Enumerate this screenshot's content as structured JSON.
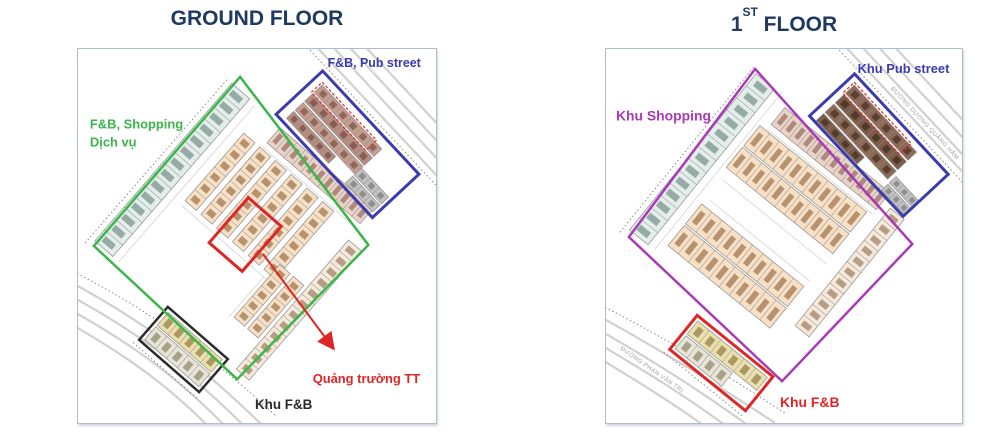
{
  "header": {
    "ground_title": "GROUND FLOOR",
    "first_title_num": "1",
    "first_title_sup": "ST",
    "first_title_rest": " FLOOR",
    "title_color": "#1e3a62"
  },
  "panels": {
    "ground": {
      "zones": {
        "shopping": {
          "label_line1": "F&B, Shopping",
          "label_line2": "Dịch vụ",
          "color": "#3cb54a"
        },
        "pub": {
          "label": "F&B, Pub street",
          "color": "#3b3bae"
        },
        "fnb": {
          "label": "Khu F&B",
          "color": "#2b2b2b"
        },
        "square": {
          "label": "Quảng trường TT",
          "color": "#e02525"
        }
      }
    },
    "first": {
      "zones": {
        "shopping": {
          "label": "Khu Shopping",
          "color": "#a83ab8"
        },
        "pub": {
          "label": "Khu Pub street",
          "color": "#3b3bae"
        },
        "fnb": {
          "label": "Khu F&B",
          "color": "#e02525"
        }
      },
      "roads": {
        "right_road": "ĐƯỜNG DƯƠNG QUẢNG HÀM",
        "bottom_road": "ĐƯỜNG PHAN VĂN TRỊ"
      }
    }
  },
  "map_colors": {
    "road": "#d0d0d0",
    "dotted_boundary": "#8a8a8a",
    "teal_row": "#e3eeea",
    "teal_row_hatch": "#7c948e",
    "peach": "#f7e0c5",
    "peach_hatch": "#a07850",
    "pink1": "#e9d2c6",
    "pink1_hatch": "#9a7265",
    "pink2": "#e3cabe",
    "pink2_hatch": "#93705f",
    "brown_light": "#c59d91",
    "brown_light_hatch": "#7c564a",
    "brown_mid": "#b78c80",
    "brown_mid_hatch": "#74504a",
    "brown_dark": "#8d6a55",
    "brown_dark_hatch": "#4a3227",
    "brown_dark2": "#7c5c49",
    "brown_dark2_hatch": "#42301f",
    "gray_block": "#c2c2c2",
    "gray_block_hatch": "#7d7d7d",
    "yellow": "#ebdfad",
    "yellow_hatch": "#91834a",
    "cream": "#e9e5d6",
    "cream_hatch": "#8f8a6f",
    "bottom_row": "#f5e9dc",
    "bottom_row_hatch": "#9f8468"
  }
}
